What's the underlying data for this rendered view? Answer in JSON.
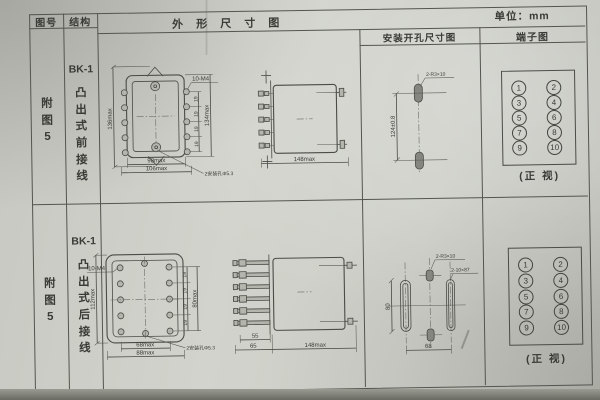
{
  "unit_label": "单位：mm",
  "colors": {
    "line": "#4b4b47",
    "paper": "#cdcec7",
    "text": "#3a3a36"
  },
  "headers": {
    "fig": "图号",
    "structure": "结构",
    "outline": "外 形 尺 寸 图",
    "install": "安装开孔尺寸图",
    "terminal": "端子图"
  },
  "rows": [
    {
      "fig": "附图5",
      "model": "BK-1",
      "structure": "凸出式前接线",
      "dims": {
        "thread": "10-M4",
        "h_left": "136max",
        "h_right": "134max",
        "pitch": "19",
        "w_inner": "98max",
        "w_outer": "106max",
        "mount": "2安装孔Φ5.3",
        "depth": "148max"
      },
      "install": {
        "slot": "2-R3×10",
        "v": "124±0.8"
      },
      "terminal": {
        "cells": [
          "1",
          "2",
          "3",
          "4",
          "5",
          "6",
          "7",
          "8",
          "9",
          "10"
        ],
        "caption": "(正 视)"
      }
    },
    {
      "fig": "附图5",
      "model": "BK-1",
      "structure": "凸出式后接线",
      "dims": {
        "thread": "10-M4",
        "h_left": "112max",
        "h_right": "80max",
        "pitch": "19",
        "w_inner": "68max",
        "w_outer": "88max",
        "mount": "2安装孔Φ5.3",
        "stud_inner": "55",
        "stud_outer": "65",
        "depth": "148max"
      },
      "install": {
        "slot_small": "2-R3×10",
        "slot_long": "2-10×87",
        "v": "80",
        "h": "68"
      },
      "terminal": {
        "cells": [
          "1",
          "2",
          "3",
          "4",
          "5",
          "6",
          "7",
          "8",
          "9",
          "10"
        ],
        "caption": "(正 视)"
      }
    }
  ]
}
